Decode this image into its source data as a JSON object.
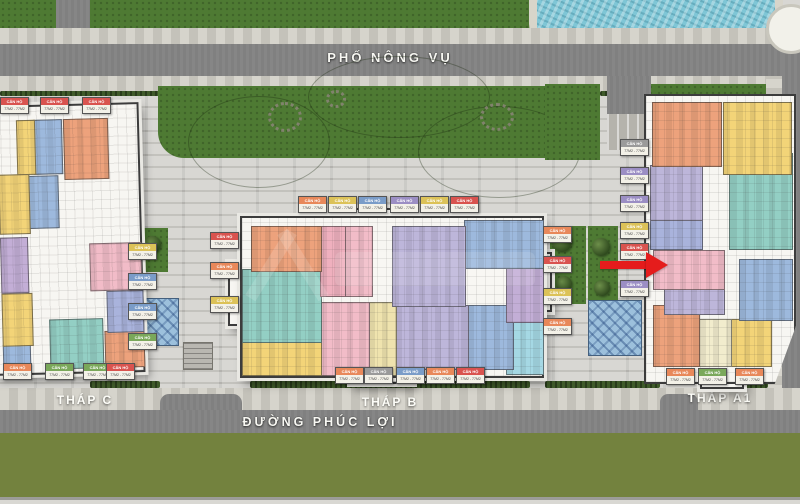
{
  "streets": {
    "top": "PHỐ NÔNG VỤ",
    "bottom": "ĐƯỜNG PHÚC LỢI"
  },
  "towers": {
    "c": {
      "name": "THÁP C"
    },
    "b": {
      "name": "THÁP B"
    },
    "a1": {
      "name": "THÁP A1"
    }
  },
  "tag": {
    "label": "CĂN HỘ",
    "area": "77M2 - 77M2"
  },
  "arrow": {
    "color": "#e51c1c",
    "points_to": "tower-a1-pink-unit"
  },
  "colors": {
    "orange": "#eda27c",
    "yellow": "#f3d478",
    "paleyellow": "#efe3ae",
    "cream": "#f2eccd",
    "blue": "#9db9dd",
    "periwinkle": "#a9b3dc",
    "lavender": "#bdb6da",
    "purple": "#c3aed6",
    "teal": "#93cfc4",
    "cyan": "#a5d8e4",
    "pink": "#f2bcc8",
    "rose": "#efb0be"
  },
  "tag_colors": {
    "red": "#d9534f",
    "orange": "#e8885a",
    "yellow": "#dcc258",
    "green": "#7aa85a",
    "blue": "#7a9cc8",
    "purple": "#9b8ec4",
    "gray": "#9a9a9a",
    "pink": "#d98aa0"
  },
  "units": {
    "c": [
      [
        17,
        5,
        12,
        20,
        "yellow"
      ],
      [
        29,
        5,
        18,
        20,
        "blue"
      ],
      [
        49,
        5,
        30,
        22,
        "orange"
      ],
      [
        4,
        25,
        20,
        22,
        "yellow"
      ],
      [
        24,
        26,
        20,
        19,
        "blue"
      ],
      [
        4,
        49,
        18,
        20,
        "purple"
      ],
      [
        65,
        52,
        34,
        17,
        "pink"
      ],
      [
        4,
        70,
        20,
        19,
        "yellow"
      ],
      [
        76,
        70,
        24,
        15,
        "periwinkle"
      ],
      [
        36,
        80,
        36,
        18,
        "teal"
      ],
      [
        74,
        85,
        26,
        13,
        "orange"
      ],
      [
        4,
        89,
        18,
        9,
        "blue"
      ]
    ],
    "b": [
      [
        3,
        5,
        23,
        28,
        "orange"
      ],
      [
        26,
        5,
        8,
        44,
        "rose"
      ],
      [
        34,
        5,
        9,
        44,
        "pink"
      ],
      [
        50,
        5,
        24,
        50,
        "lavender"
      ],
      [
        74,
        1,
        26,
        30,
        "blue"
      ],
      [
        88,
        31,
        12,
        34,
        "purple"
      ],
      [
        0,
        32,
        26,
        46,
        "teal"
      ],
      [
        0,
        78,
        26,
        21,
        "yellow"
      ],
      [
        26,
        53,
        16,
        46,
        "pink"
      ],
      [
        42,
        53,
        9,
        46,
        "paleyellow"
      ],
      [
        51,
        55,
        24,
        40,
        "lavender"
      ],
      [
        75,
        55,
        15,
        40,
        "blue"
      ],
      [
        88,
        65,
        12,
        33,
        "cyan"
      ]
    ],
    "a1": [
      [
        4,
        2,
        46,
        22,
        "orange"
      ],
      [
        52,
        2,
        45,
        25,
        "yellow"
      ],
      [
        3,
        24,
        34,
        19,
        "lavender"
      ],
      [
        3,
        43,
        34,
        10,
        "periwinkle"
      ],
      [
        56,
        20,
        42,
        33,
        "teal"
      ],
      [
        5,
        54,
        47,
        13,
        "pink"
      ],
      [
        12,
        67,
        40,
        9,
        "lavender"
      ],
      [
        63,
        57,
        35,
        21,
        "blue"
      ],
      [
        5,
        73,
        30,
        21,
        "orange"
      ],
      [
        36,
        78,
        21,
        16,
        "cream"
      ],
      [
        57,
        78,
        27,
        16,
        "yellow"
      ]
    ]
  },
  "tags": [
    {
      "x": 0,
      "y": 97,
      "c": "red"
    },
    {
      "x": 40,
      "y": 97,
      "c": "red"
    },
    {
      "x": 82,
      "y": 97,
      "c": "red"
    },
    {
      "x": 128,
      "y": 243,
      "c": "yellow"
    },
    {
      "x": 128,
      "y": 273,
      "c": "blue"
    },
    {
      "x": 128,
      "y": 303,
      "c": "blue"
    },
    {
      "x": 128,
      "y": 333,
      "c": "green"
    },
    {
      "x": 3,
      "y": 363,
      "c": "orange"
    },
    {
      "x": 45,
      "y": 363,
      "c": "green"
    },
    {
      "x": 83,
      "y": 363,
      "c": "green"
    },
    {
      "x": 106,
      "y": 363,
      "c": "red"
    },
    {
      "x": 210,
      "y": 232,
      "c": "red"
    },
    {
      "x": 210,
      "y": 262,
      "c": "orange"
    },
    {
      "x": 210,
      "y": 296,
      "c": "yellow"
    },
    {
      "x": 298,
      "y": 196,
      "c": "orange"
    },
    {
      "x": 328,
      "y": 196,
      "c": "yellow"
    },
    {
      "x": 358,
      "y": 196,
      "c": "blue"
    },
    {
      "x": 390,
      "y": 196,
      "c": "purple"
    },
    {
      "x": 420,
      "y": 196,
      "c": "yellow"
    },
    {
      "x": 450,
      "y": 196,
      "c": "red"
    },
    {
      "x": 335,
      "y": 367,
      "c": "orange"
    },
    {
      "x": 364,
      "y": 367,
      "c": "gray"
    },
    {
      "x": 396,
      "y": 367,
      "c": "blue"
    },
    {
      "x": 426,
      "y": 367,
      "c": "orange"
    },
    {
      "x": 456,
      "y": 367,
      "c": "red"
    },
    {
      "x": 543,
      "y": 226,
      "c": "orange"
    },
    {
      "x": 543,
      "y": 256,
      "c": "red"
    },
    {
      "x": 543,
      "y": 288,
      "c": "yellow"
    },
    {
      "x": 543,
      "y": 318,
      "c": "orange"
    },
    {
      "x": 620,
      "y": 139,
      "c": "gray"
    },
    {
      "x": 620,
      "y": 167,
      "c": "purple"
    },
    {
      "x": 620,
      "y": 195,
      "c": "purple"
    },
    {
      "x": 620,
      "y": 222,
      "c": "yellow"
    },
    {
      "x": 620,
      "y": 243,
      "c": "red"
    },
    {
      "x": 620,
      "y": 280,
      "c": "purple"
    },
    {
      "x": 666,
      "y": 368,
      "c": "orange"
    },
    {
      "x": 698,
      "y": 368,
      "c": "green"
    },
    {
      "x": 735,
      "y": 368,
      "c": "orange"
    }
  ]
}
